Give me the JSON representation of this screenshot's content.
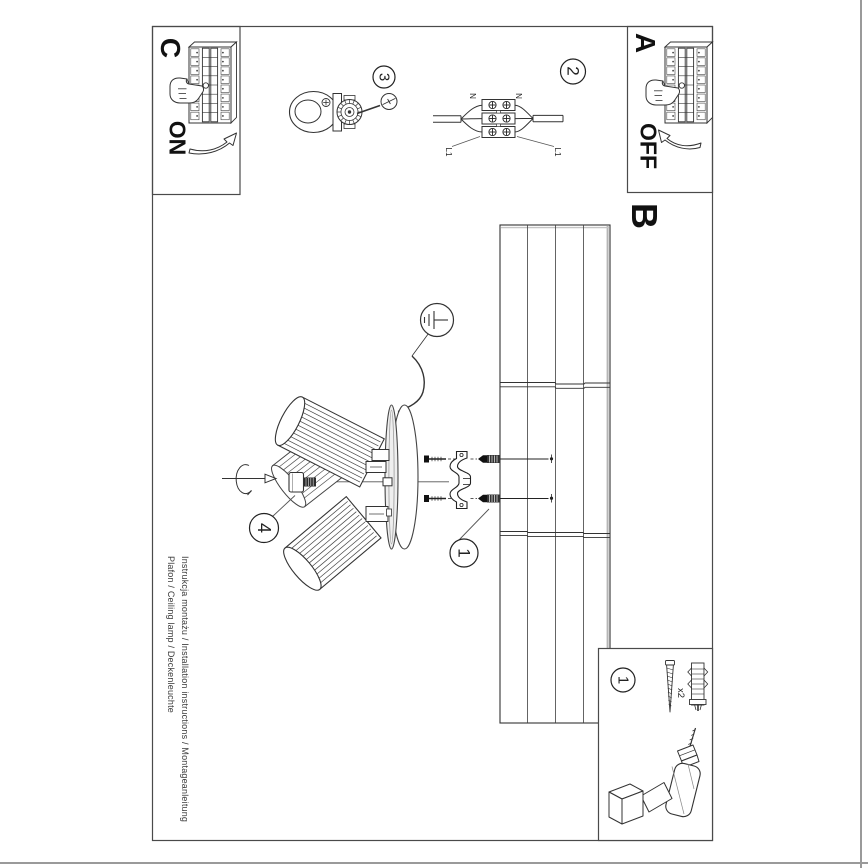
{
  "labels": {
    "a": "A",
    "b": "B",
    "c": "C",
    "on": "ON",
    "off": "OFF"
  },
  "steps": {
    "s1": "1",
    "s2": "2",
    "s3": "3",
    "s4": "4",
    "parts": "1"
  },
  "wiring": {
    "n_left": "N",
    "n_right": "N",
    "l1_left": "L1",
    "l1_right": "L1"
  },
  "parts": {
    "quantity": "x2"
  },
  "footer": {
    "line1": "Instrukcja montażu / Installation instructions / Montageanleitung",
    "line2": "Plafon / Ceiling lamp / Deckenleuchte"
  },
  "colors": {
    "line": "#2b2b2b",
    "page_edge": "#999999",
    "shade_fill": "#ffffff"
  },
  "icons": {
    "ground-icon": "earth ground symbol in circle",
    "screwdriver-icon": "flat screwdriver bit in circle",
    "rotation-arrow-icon": "screw-in rotation arrow",
    "press-hand-icon": "hand pressing breaker switch",
    "on-arrow-icon": "curved arrow up (switch on)",
    "off-arrow-icon": "curved arrow down (switch off)",
    "drill-icon": "cordless drill",
    "screw-icon": "mounting screw",
    "wall-plug-icon": "expansion wall plug",
    "terminal-block-icon": "3-pole terminal block",
    "lamp-holder-icon": "lamp holder with ring",
    "mounting-bracket-icon": "ceiling mounting strap"
  }
}
